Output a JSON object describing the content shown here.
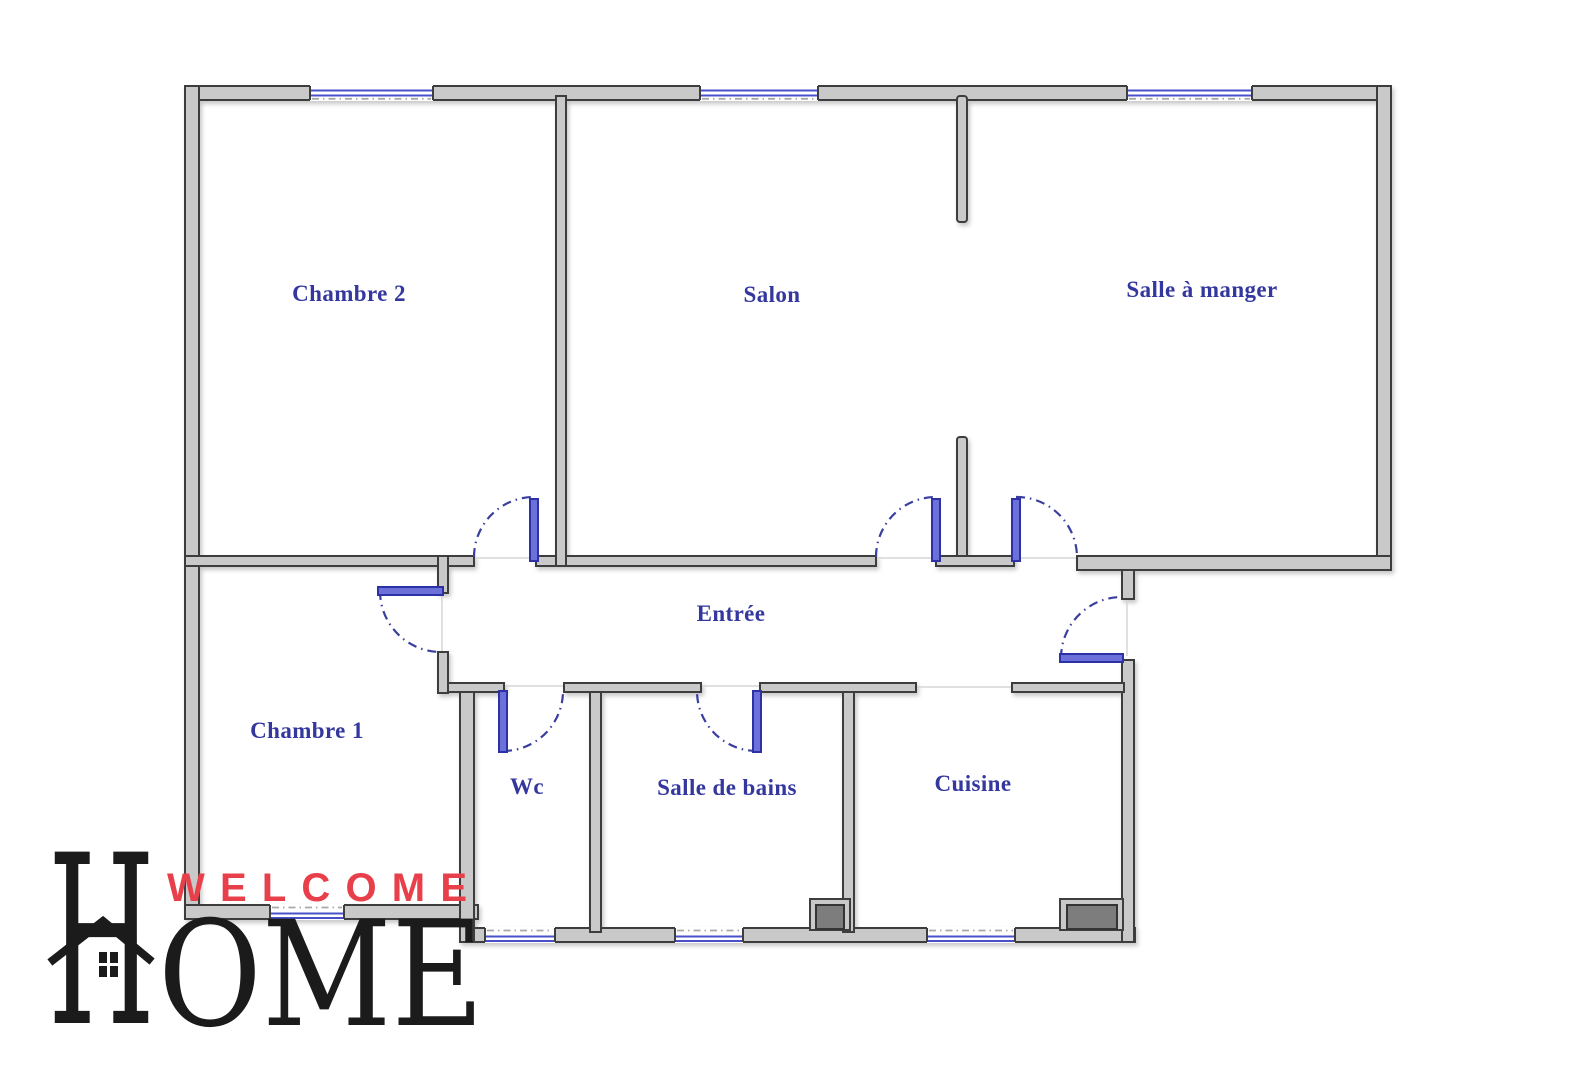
{
  "page": {
    "background": "#ffffff",
    "type": "apartment floor plan"
  },
  "floorplan": {
    "rooms": [
      {
        "name": "Chambre 2"
      },
      {
        "name": "Salon"
      },
      {
        "name": "Salle à manger"
      },
      {
        "name": "Entrée"
      },
      {
        "name": "Chambre 1"
      },
      {
        "name": "Wc"
      },
      {
        "name": "Salle de bains"
      },
      {
        "name": "Cuisine"
      }
    ],
    "colors": {
      "wall_fill": "#c9c9c9",
      "wall_outline": "#3e3e3e",
      "door_leaf": "#5b61cf",
      "door_arc": "#3a3f9e",
      "window_blue": "#4a50c8",
      "room_label": "#33379e",
      "fixture_dark": "#7d7d7d"
    }
  },
  "logo": {
    "welcome": "WELCOME",
    "home_initial": "H",
    "home_rest": "OME",
    "welcome_color": "#e8404b",
    "home_color": "#1b1b1b",
    "icon": "house-icon"
  }
}
